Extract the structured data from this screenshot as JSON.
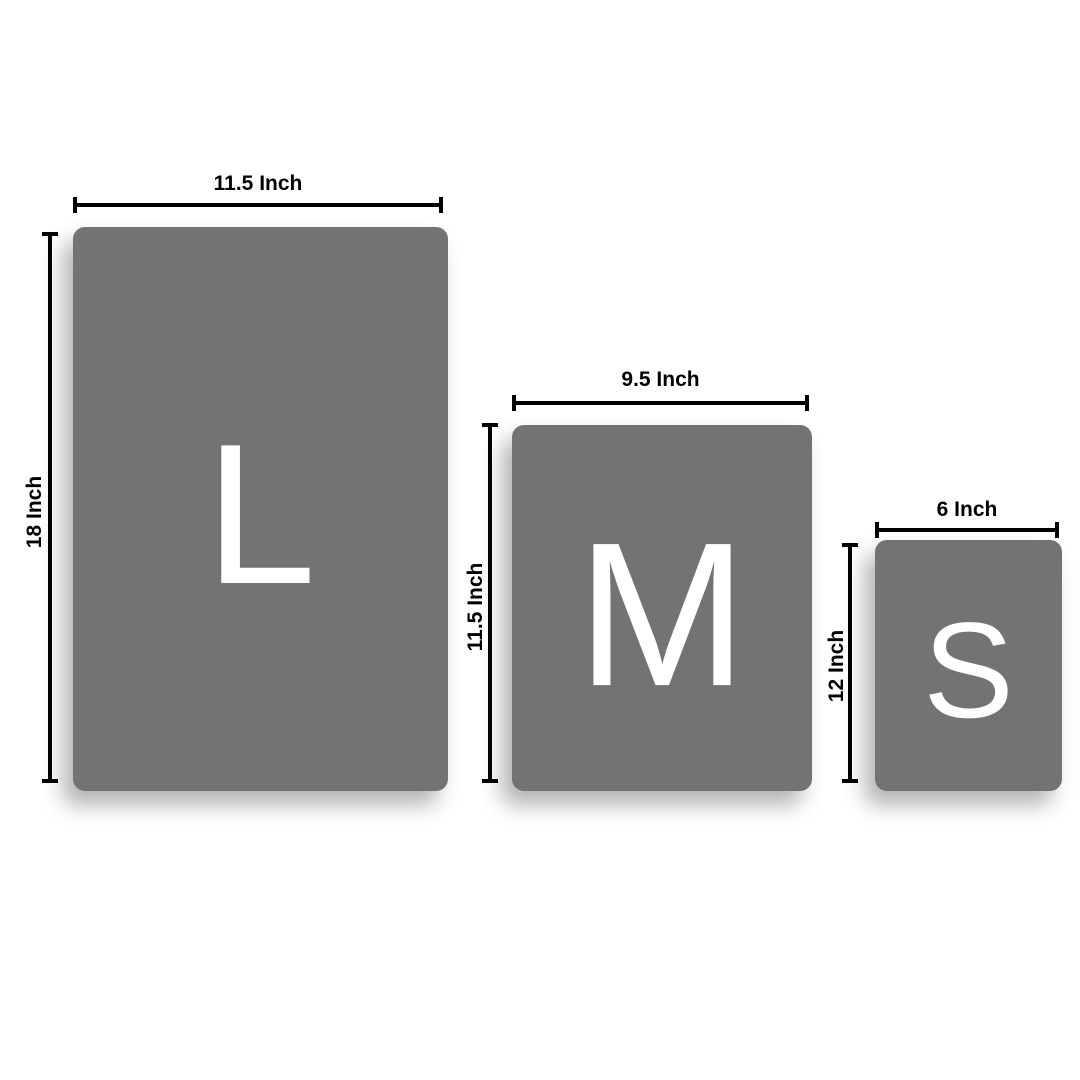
{
  "title": "Board size comparison",
  "colors": {
    "background": "#ffffff",
    "panel_fill": "#737373",
    "letter": "#ffffff",
    "dimension": "#000000"
  },
  "panels": [
    {
      "id": "large",
      "letter": "L",
      "width_label": "11.5 Inch",
      "height_label": "18 Inch"
    },
    {
      "id": "medium",
      "letter": "M",
      "width_label": "9.5 Inch",
      "height_label": "11.5 Inch"
    },
    {
      "id": "small",
      "letter": "S",
      "width_label": "6 Inch",
      "height_label": "12 Inch"
    }
  ]
}
